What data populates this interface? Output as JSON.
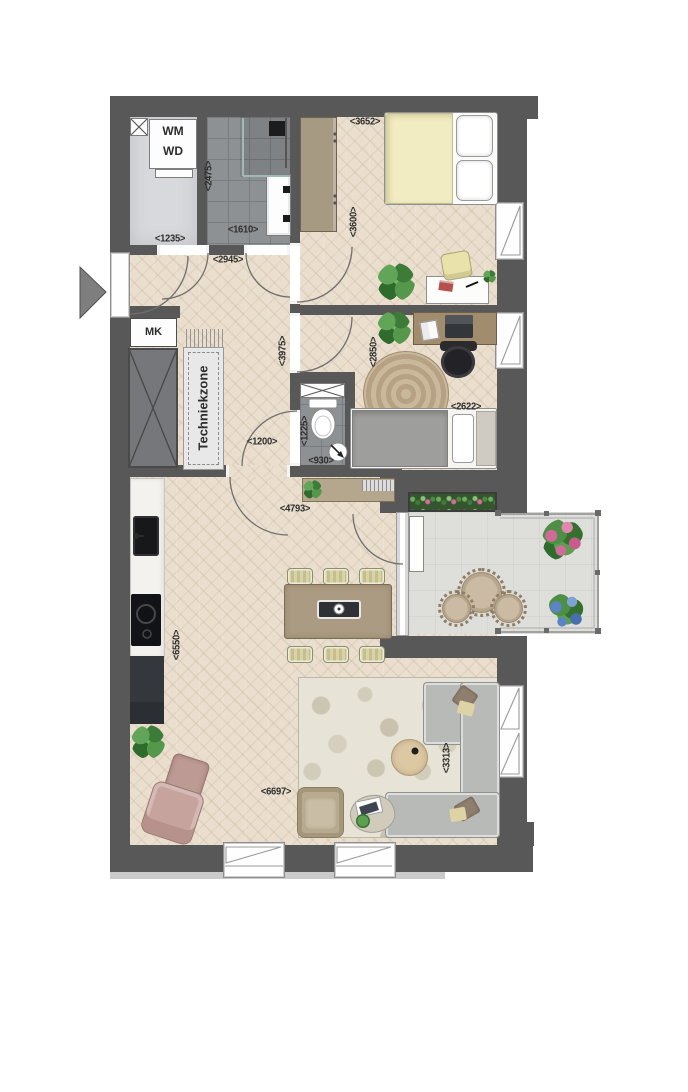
{
  "title": "Apartment floor plan",
  "palette": {
    "wall": "#585858",
    "wood_floor": "#eadfce",
    "tile_floor": "#8e9194",
    "laundry_floor": "#d8d9dc",
    "balcony_floor": "#dedfda",
    "bed_accent": "#f2ecc2",
    "plant_green": "#4e8f45",
    "terrace_pink": "#d06a98",
    "terrace_blue": "#5b84c4",
    "sofa_gray": "#b8bab8"
  },
  "labels": {
    "washer": "WM",
    "dryer": "WD",
    "meter_cupboard": "MK",
    "tech_zone": "Techniekzone"
  },
  "dims": {
    "laundry": "<1235>",
    "bathroom_v": "<2475>",
    "bathroom_h": "<1610>",
    "hall_h": "<2945>",
    "bed1_h": "<3652>",
    "bed1_v": "<3600>",
    "hall_v": "<3975>",
    "study_v": "<2850>",
    "passage": "<1200>",
    "wc_v": "<1225>",
    "wc_h": "<930>",
    "study_h": "<2622>",
    "living_h_upper": "<4793>",
    "living_v": "<6550>",
    "living_h": "<6697>",
    "lounge_v": "<3313>"
  }
}
